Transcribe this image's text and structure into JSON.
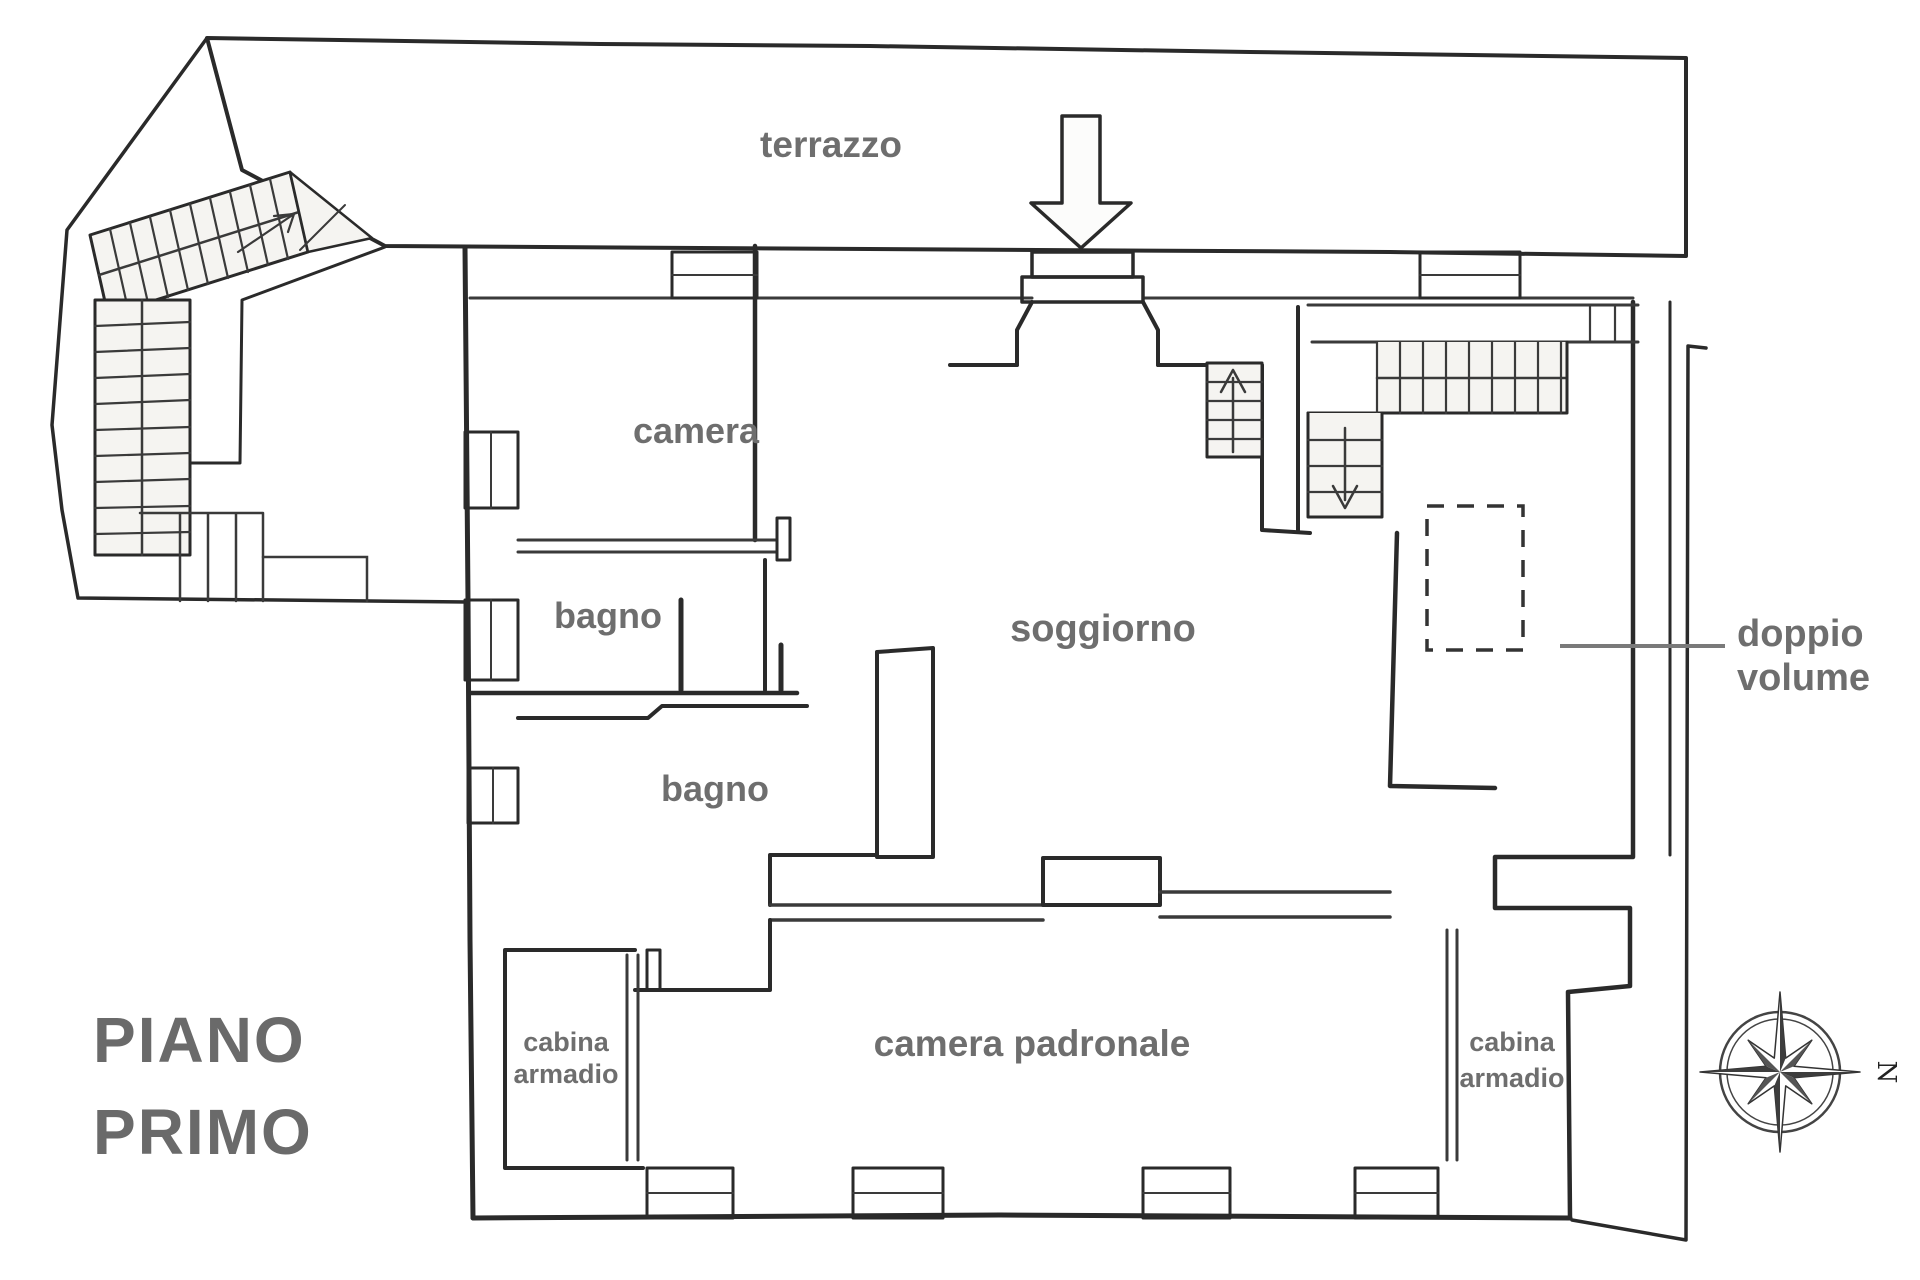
{
  "title": {
    "line1": "PIANO",
    "line2": "PRIMO"
  },
  "rooms": {
    "terrazzo": "terrazzo",
    "camera": "camera",
    "bagno_1": "bagno",
    "bagno_2": "bagno",
    "soggiorno": "soggiorno",
    "camera_padronale": "camera padronale",
    "cabina_armadio_left": {
      "line1": "cabina",
      "line2": "armadio"
    },
    "cabina_armadio_right": {
      "line1": "cabina",
      "line2": "armadio"
    }
  },
  "annotations": {
    "doppio_volume": {
      "line1": "doppio",
      "line2": "volume"
    },
    "compass_north": "N"
  },
  "colors": {
    "wall": "#2a2a2a",
    "label": "#6e6e6e",
    "title": "#6a6a6a",
    "leader": "#7a7a7a",
    "stair_fill": "#f5f4f1"
  }
}
